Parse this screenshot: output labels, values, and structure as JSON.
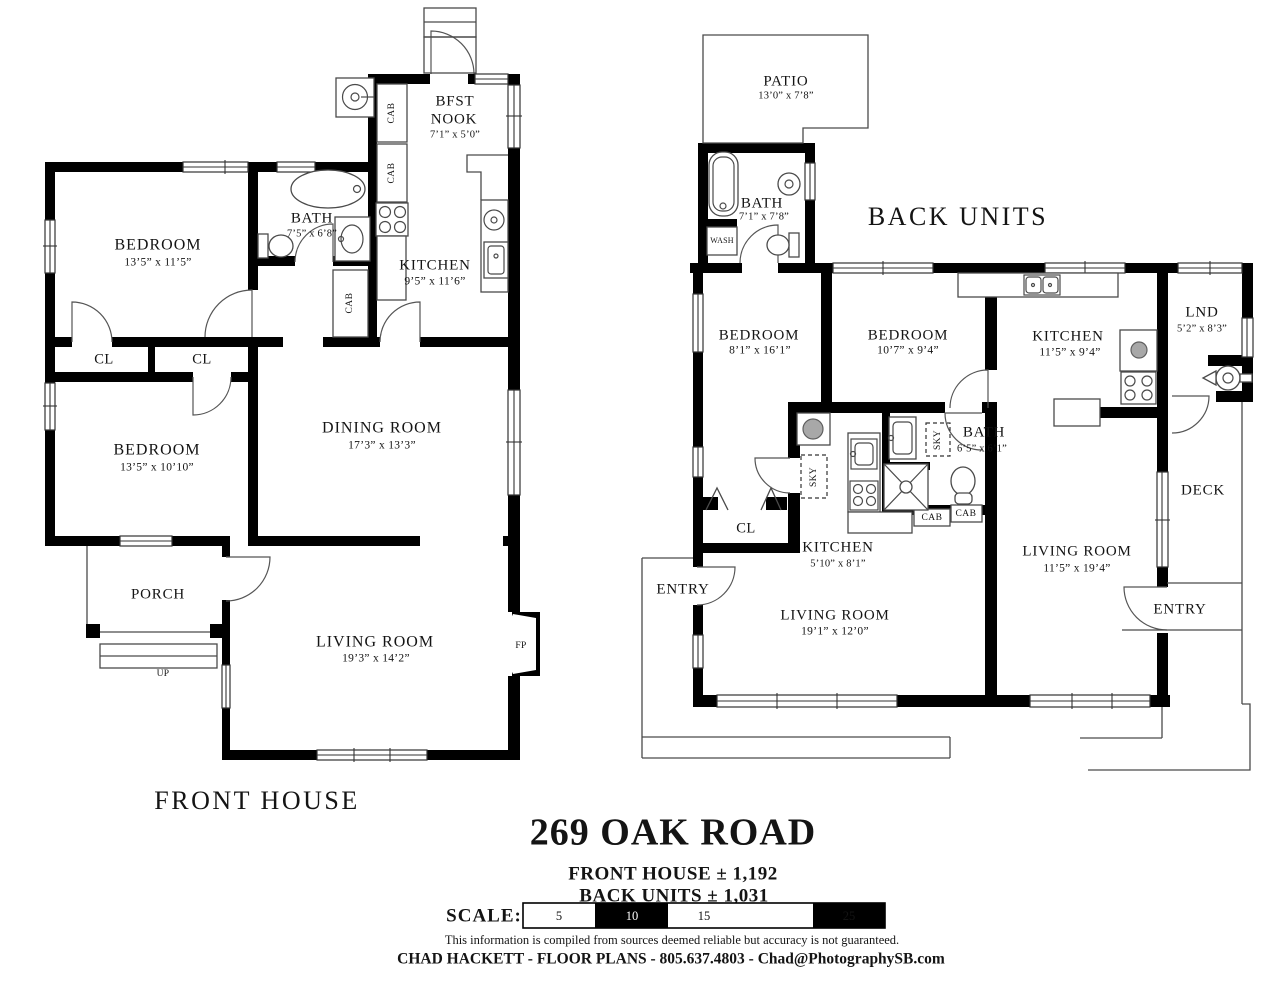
{
  "front": {
    "title": "FRONT HOUSE",
    "bedroom1": {
      "name": "BEDROOM",
      "dims": "13’5” x 11’5”"
    },
    "bath": {
      "name": "BATH",
      "dims": "7’5” x 6’8”"
    },
    "bfst": {
      "line1": "BFST",
      "line2": "NOOK",
      "dims": "7’1” x 5’0”"
    },
    "kitchen": {
      "name": "KITCHEN",
      "dims": "9’5” x 11’6”"
    },
    "closet1": "CL",
    "closet2": "CL",
    "bedroom2": {
      "name": "BEDROOM",
      "dims": "13’5” x 10’10”"
    },
    "dining": {
      "name": "DINING ROOM",
      "dims": "17’3” x 13’3”"
    },
    "porch": "PORCH",
    "up": "UP",
    "living": {
      "name": "LIVING ROOM",
      "dims": "19’3” x 14’2”"
    },
    "fireplace": "FP",
    "cab": "CAB"
  },
  "back": {
    "title": "BACK UNITS",
    "patio": {
      "name": "PATIO",
      "dims": "13’0” x 7’8”"
    },
    "bath1": {
      "name": "BATH",
      "dims": "7’1” x 7’8”"
    },
    "wash": "WASH",
    "bedroom1": {
      "name": "BEDROOM",
      "dims": "8’1” x 16’1”"
    },
    "bedroom2": {
      "name": "BEDROOM",
      "dims": "10’7” x 9’4”"
    },
    "kitchen2": {
      "name": "KITCHEN",
      "dims": "11’5” x 9’4”"
    },
    "lnd": {
      "name": "LND",
      "dims": "5’2” x 8’3”"
    },
    "bath2": {
      "name": "BATH",
      "dims": "6’5” x 6’1”"
    },
    "sky": "SKY",
    "closet": "CL",
    "kitchen1": {
      "name": "KITCHEN",
      "dims": "5’10” x 8’1”"
    },
    "living1": {
      "name": "LIVING ROOM",
      "dims": "19’1” x 12’0”"
    },
    "living2": {
      "name": "LIVING ROOM",
      "dims": "11’5” x 19’4”"
    },
    "deck": "DECK",
    "entry_left": "ENTRY",
    "entry_right": "ENTRY",
    "cab": "CAB"
  },
  "footer": {
    "address": "269 OAK ROAD",
    "front_area": "FRONT HOUSE ± 1,192",
    "back_area": "BACK UNITS ± 1,031",
    "scale_label": "SCALE:",
    "scale_ticks": [
      "5",
      "10",
      "15",
      "20",
      "25"
    ],
    "disclaimer": "This information is compiled from sources deemed reliable but accuracy is not guaranteed.",
    "credit": "CHAD HACKETT - FLOOR PLANS - 805.637.4803 - Chad@PhotographySB.com"
  },
  "colors": {
    "wall": "#000000",
    "line": "#4a4a4a",
    "text": "#141414",
    "background": "#ffffff"
  }
}
